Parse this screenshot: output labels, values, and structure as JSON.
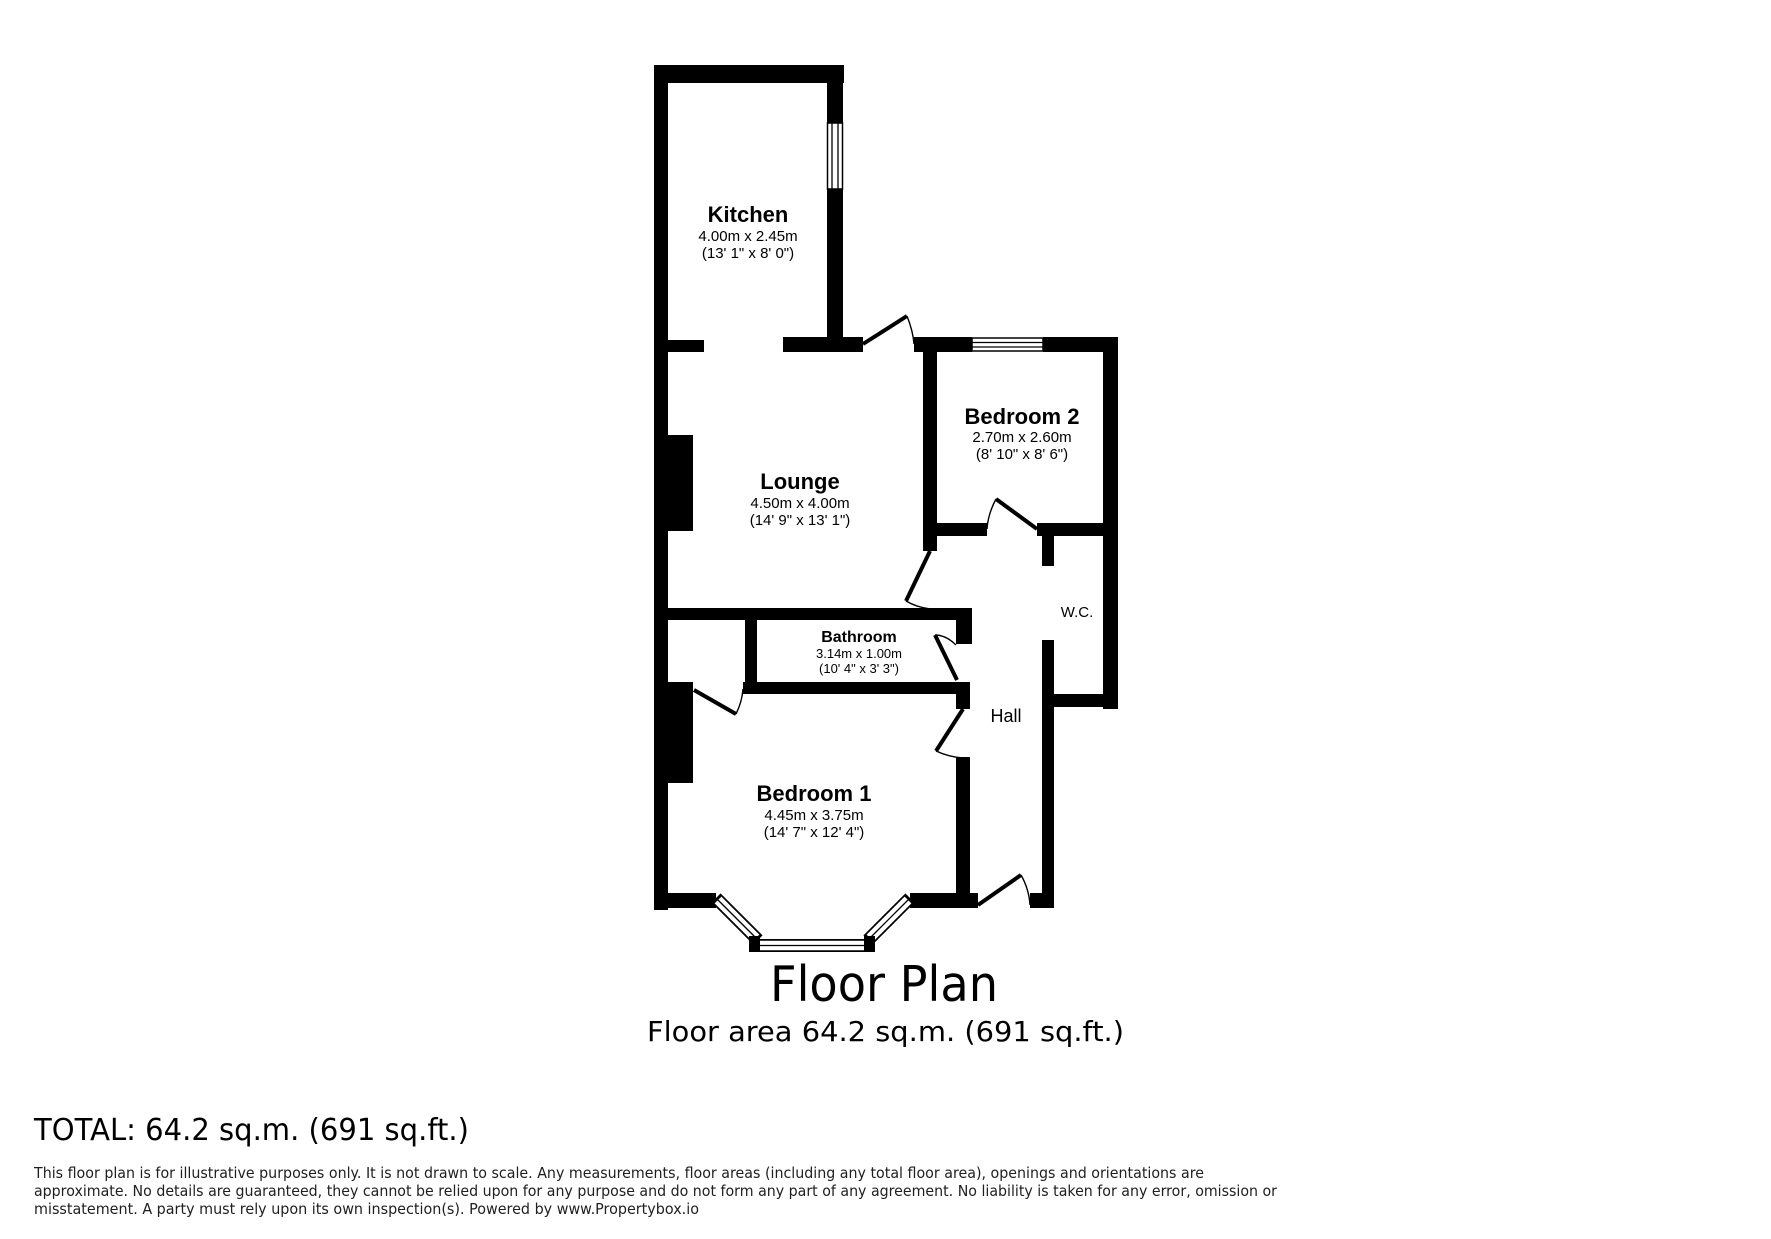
{
  "title": "Floor Plan",
  "subtitle": "Floor area 64.2 sq.m. (691 sq.ft.)",
  "total_line": "TOTAL: 64.2 sq.m. (691 sq.ft.)",
  "disclaimer": [
    "This floor plan is for illustrative purposes only. It is not drawn to scale. Any measurements, floor areas (including any total floor area), openings and orientations are",
    "approximate. No details are guaranteed, they cannot be relied upon for any purpose and do not form any part of any agreement. No liability is taken for any error, omission or",
    "misstatement. A party must rely upon its own inspection(s). Powered by www.Propertybox.io"
  ],
  "plan": {
    "wall_color": "#000000",
    "background": "#ffffff",
    "rooms": {
      "kitchen": {
        "name": "Kitchen",
        "metric": "4.00m x 2.45m",
        "imperial": "(13' 1\" x 8' 0\")"
      },
      "lounge": {
        "name": "Lounge",
        "metric": "4.50m x 4.00m",
        "imperial": "(14' 9\" x 13' 1\")"
      },
      "bedroom2": {
        "name": "Bedroom 2",
        "metric": "2.70m x 2.60m",
        "imperial": "(8' 10\" x 8' 6\")"
      },
      "bathroom": {
        "name": "Bathroom",
        "metric": "3.14m x 1.00m",
        "imperial": "(10' 4\" x 3' 3\")"
      },
      "bedroom1": {
        "name": "Bedroom 1",
        "metric": "4.45m x 3.75m",
        "imperial": "(14' 7\" x 12' 4\")"
      },
      "wc": {
        "name": "W.C."
      },
      "hall": {
        "name": "Hall"
      }
    }
  }
}
